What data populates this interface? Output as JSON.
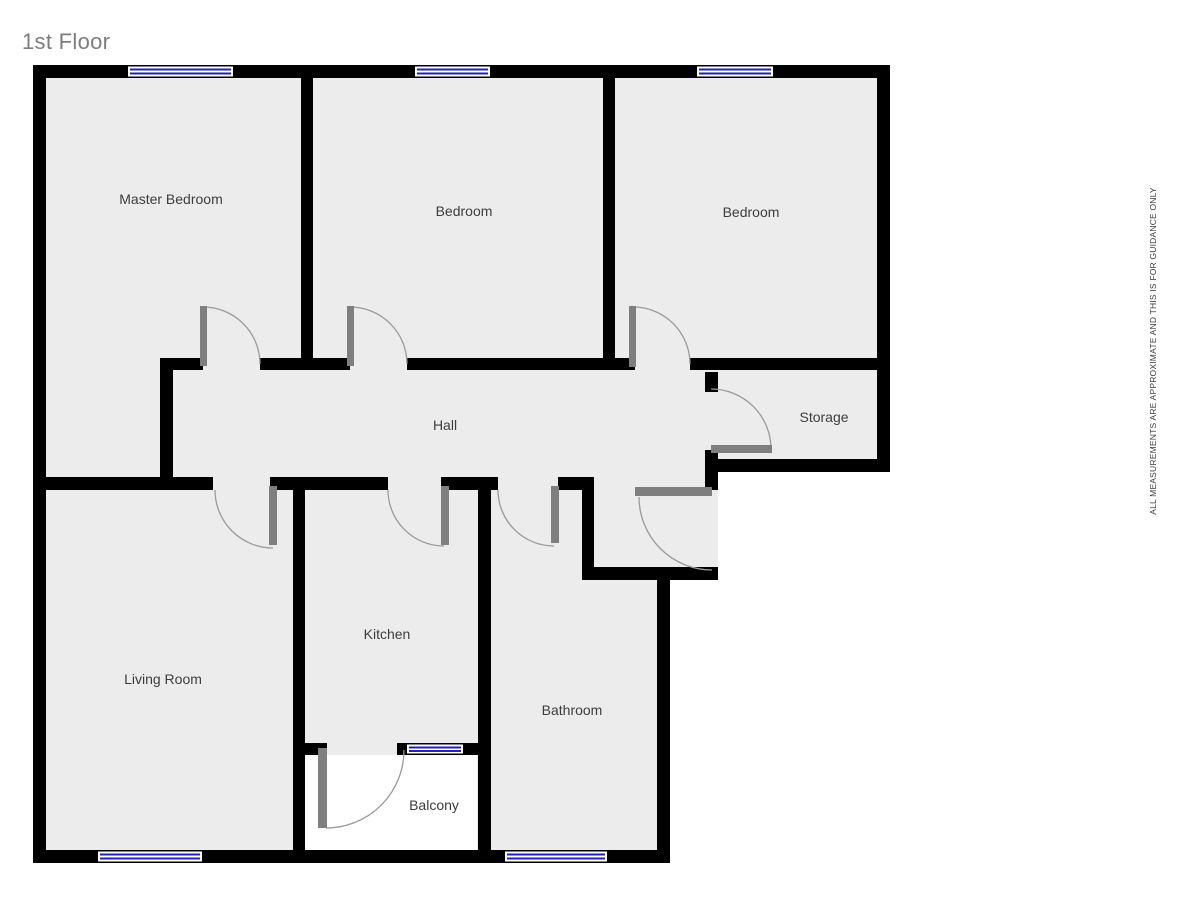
{
  "title": "1st Floor",
  "disclaimer": "ALL MEASUREMENTS ARE APPROXIMATE AND THIS IS FOR GUIDANCE ONLY",
  "rooms": {
    "master_bedroom": {
      "label": "Master Bedroom"
    },
    "bedroom_2": {
      "label": "Bedroom"
    },
    "bedroom_3": {
      "label": "Bedroom"
    },
    "hall": {
      "label": "Hall"
    },
    "storage": {
      "label": "Storage"
    },
    "living_room": {
      "label": "Living Room"
    },
    "kitchen": {
      "label": "Kitchen"
    },
    "bathroom": {
      "label": "Bathroom"
    },
    "balcony": {
      "label": "Balcony"
    }
  },
  "colors": {
    "wall": "#000000",
    "floor_fill": "#ececec",
    "outside": "#ffffff",
    "window_glass_line": "#2222b0",
    "door_panel": "#7f7f7f",
    "door_swing_arc": "#9a9a9a",
    "title_text": "#7d7d7d",
    "label_text": "#3d3d3d"
  }
}
